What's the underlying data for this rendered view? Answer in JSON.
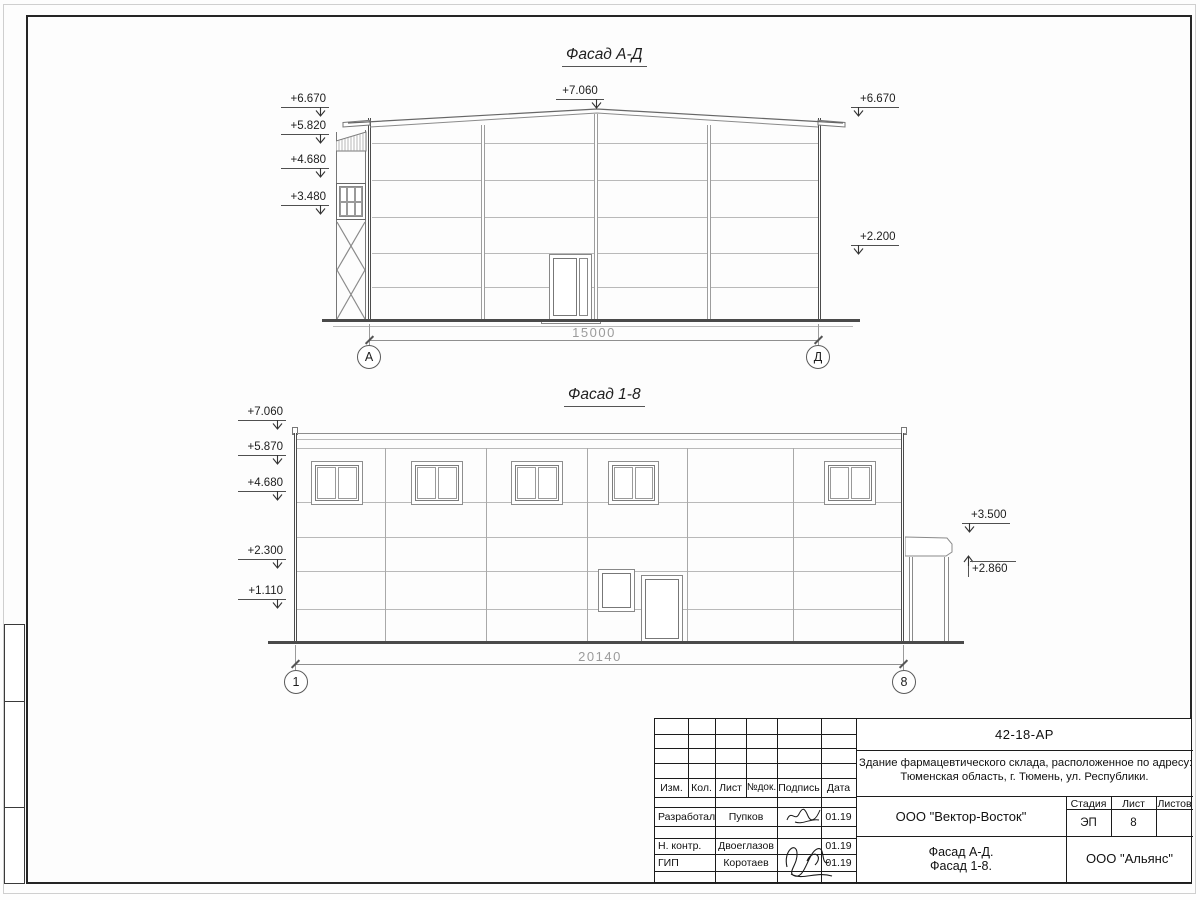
{
  "facade_ad": {
    "title": "Фасад А-Д",
    "levels_left": [
      "+6.670",
      "+5.820",
      "+4.680",
      "+3.480"
    ],
    "level_ridge": "+7.060",
    "levels_right": [
      "+6.670",
      "+2.200"
    ],
    "dimension": "15000",
    "axis_left": "А",
    "axis_right": "Д"
  },
  "facade_18": {
    "title": "Фасад 1-8",
    "levels_left": [
      "+7.060",
      "+5.870",
      "+4.680",
      "+2.300",
      "+1.110"
    ],
    "levels_right": [
      "+3.500",
      "+2.860"
    ],
    "dimension": "20140",
    "axis_left": "1",
    "axis_right": "8"
  },
  "title_block": {
    "doc_number": "42-18-АР",
    "description_line1": "Здание фармацевтического склада, расположенное по адресу:",
    "description_line2": "Тюменская область, г. Тюмень, ул. Республики.",
    "table_headers": [
      "Изм.",
      "Кол.",
      "Лист",
      "№док.",
      "Подпись",
      "Дата"
    ],
    "rows": [
      {
        "role": "Разработал",
        "name": "Пупков",
        "date": "01.19"
      },
      {
        "role": "Н. контр.",
        "name": "Двоеглазов",
        "date": "01.19"
      },
      {
        "role": "ГИП",
        "name": "Коротаев",
        "date": "01.19"
      }
    ],
    "designer_org": "ООО \"Вектор-Восток\"",
    "stage_header": [
      "Стадия",
      "Лист",
      "Листов"
    ],
    "stage": "ЭП",
    "sheet_number": "8",
    "content_line1": "Фасад А-Д.",
    "content_line2": "Фасад 1-8.",
    "client_org": "ООО \"Альянс\""
  }
}
